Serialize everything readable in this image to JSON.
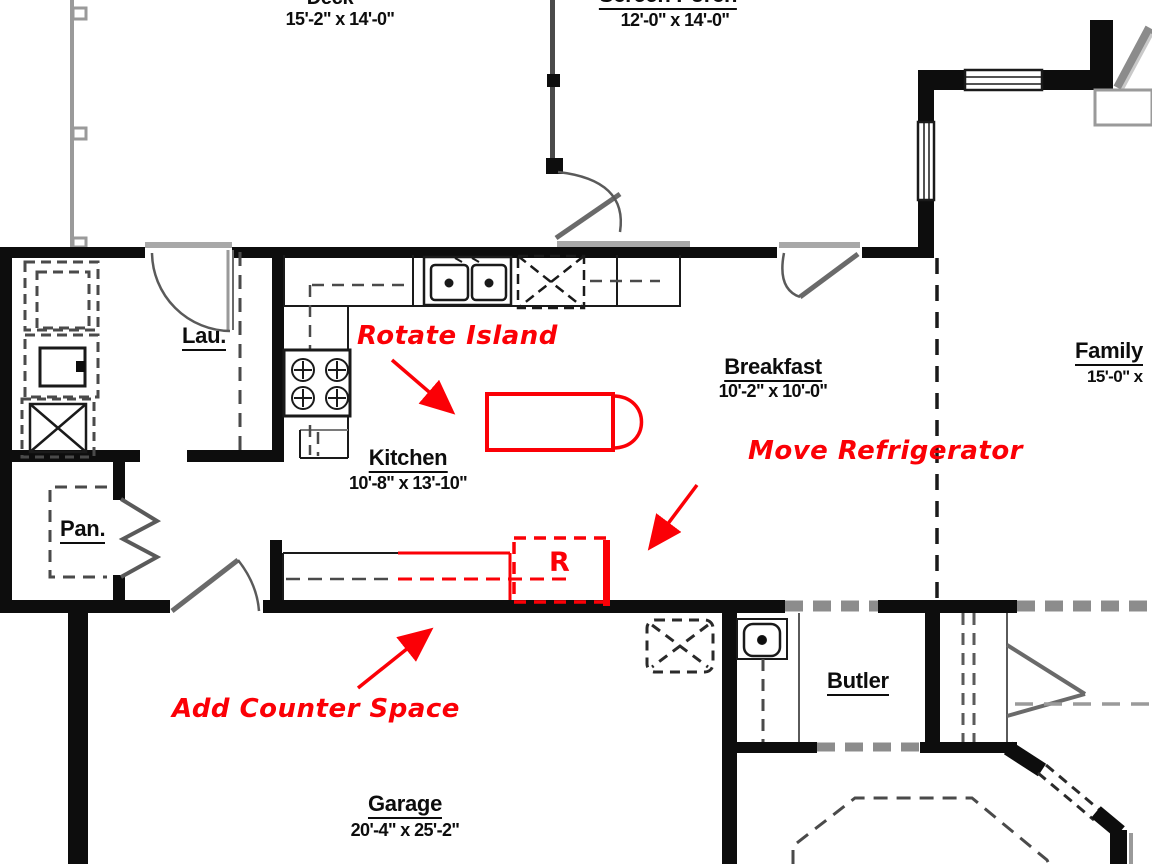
{
  "colors": {
    "annotation_red": "#fb0006",
    "wall_black": "#0d0d0d",
    "thin_gray": "#999999"
  },
  "rooms": {
    "deck": {
      "label": "Deck",
      "dims": "15'-2\" x 14'-0\""
    },
    "screen_porch": {
      "label": "Screen Porch",
      "dims": "12'-0\" x 14'-0\""
    },
    "laundry": {
      "label": "Lau."
    },
    "kitchen": {
      "label": "Kitchen",
      "dims": "10'-8\" x 13'-10\""
    },
    "breakfast": {
      "label": "Breakfast",
      "dims": "10'-2\" x 10'-0\""
    },
    "family": {
      "label": "Family",
      "dims": "15'-0\" x"
    },
    "pantry": {
      "label": "Pan."
    },
    "butler": {
      "label": "Butler"
    },
    "garage": {
      "label": "Garage",
      "dims": "20'-4\" x 25'-2\""
    }
  },
  "annotations": {
    "rotate_island": "Rotate Island",
    "move_refrigerator": "Move Refrigerator",
    "add_counter_space": "Add Counter Space",
    "refrigerator_marker": "R"
  }
}
